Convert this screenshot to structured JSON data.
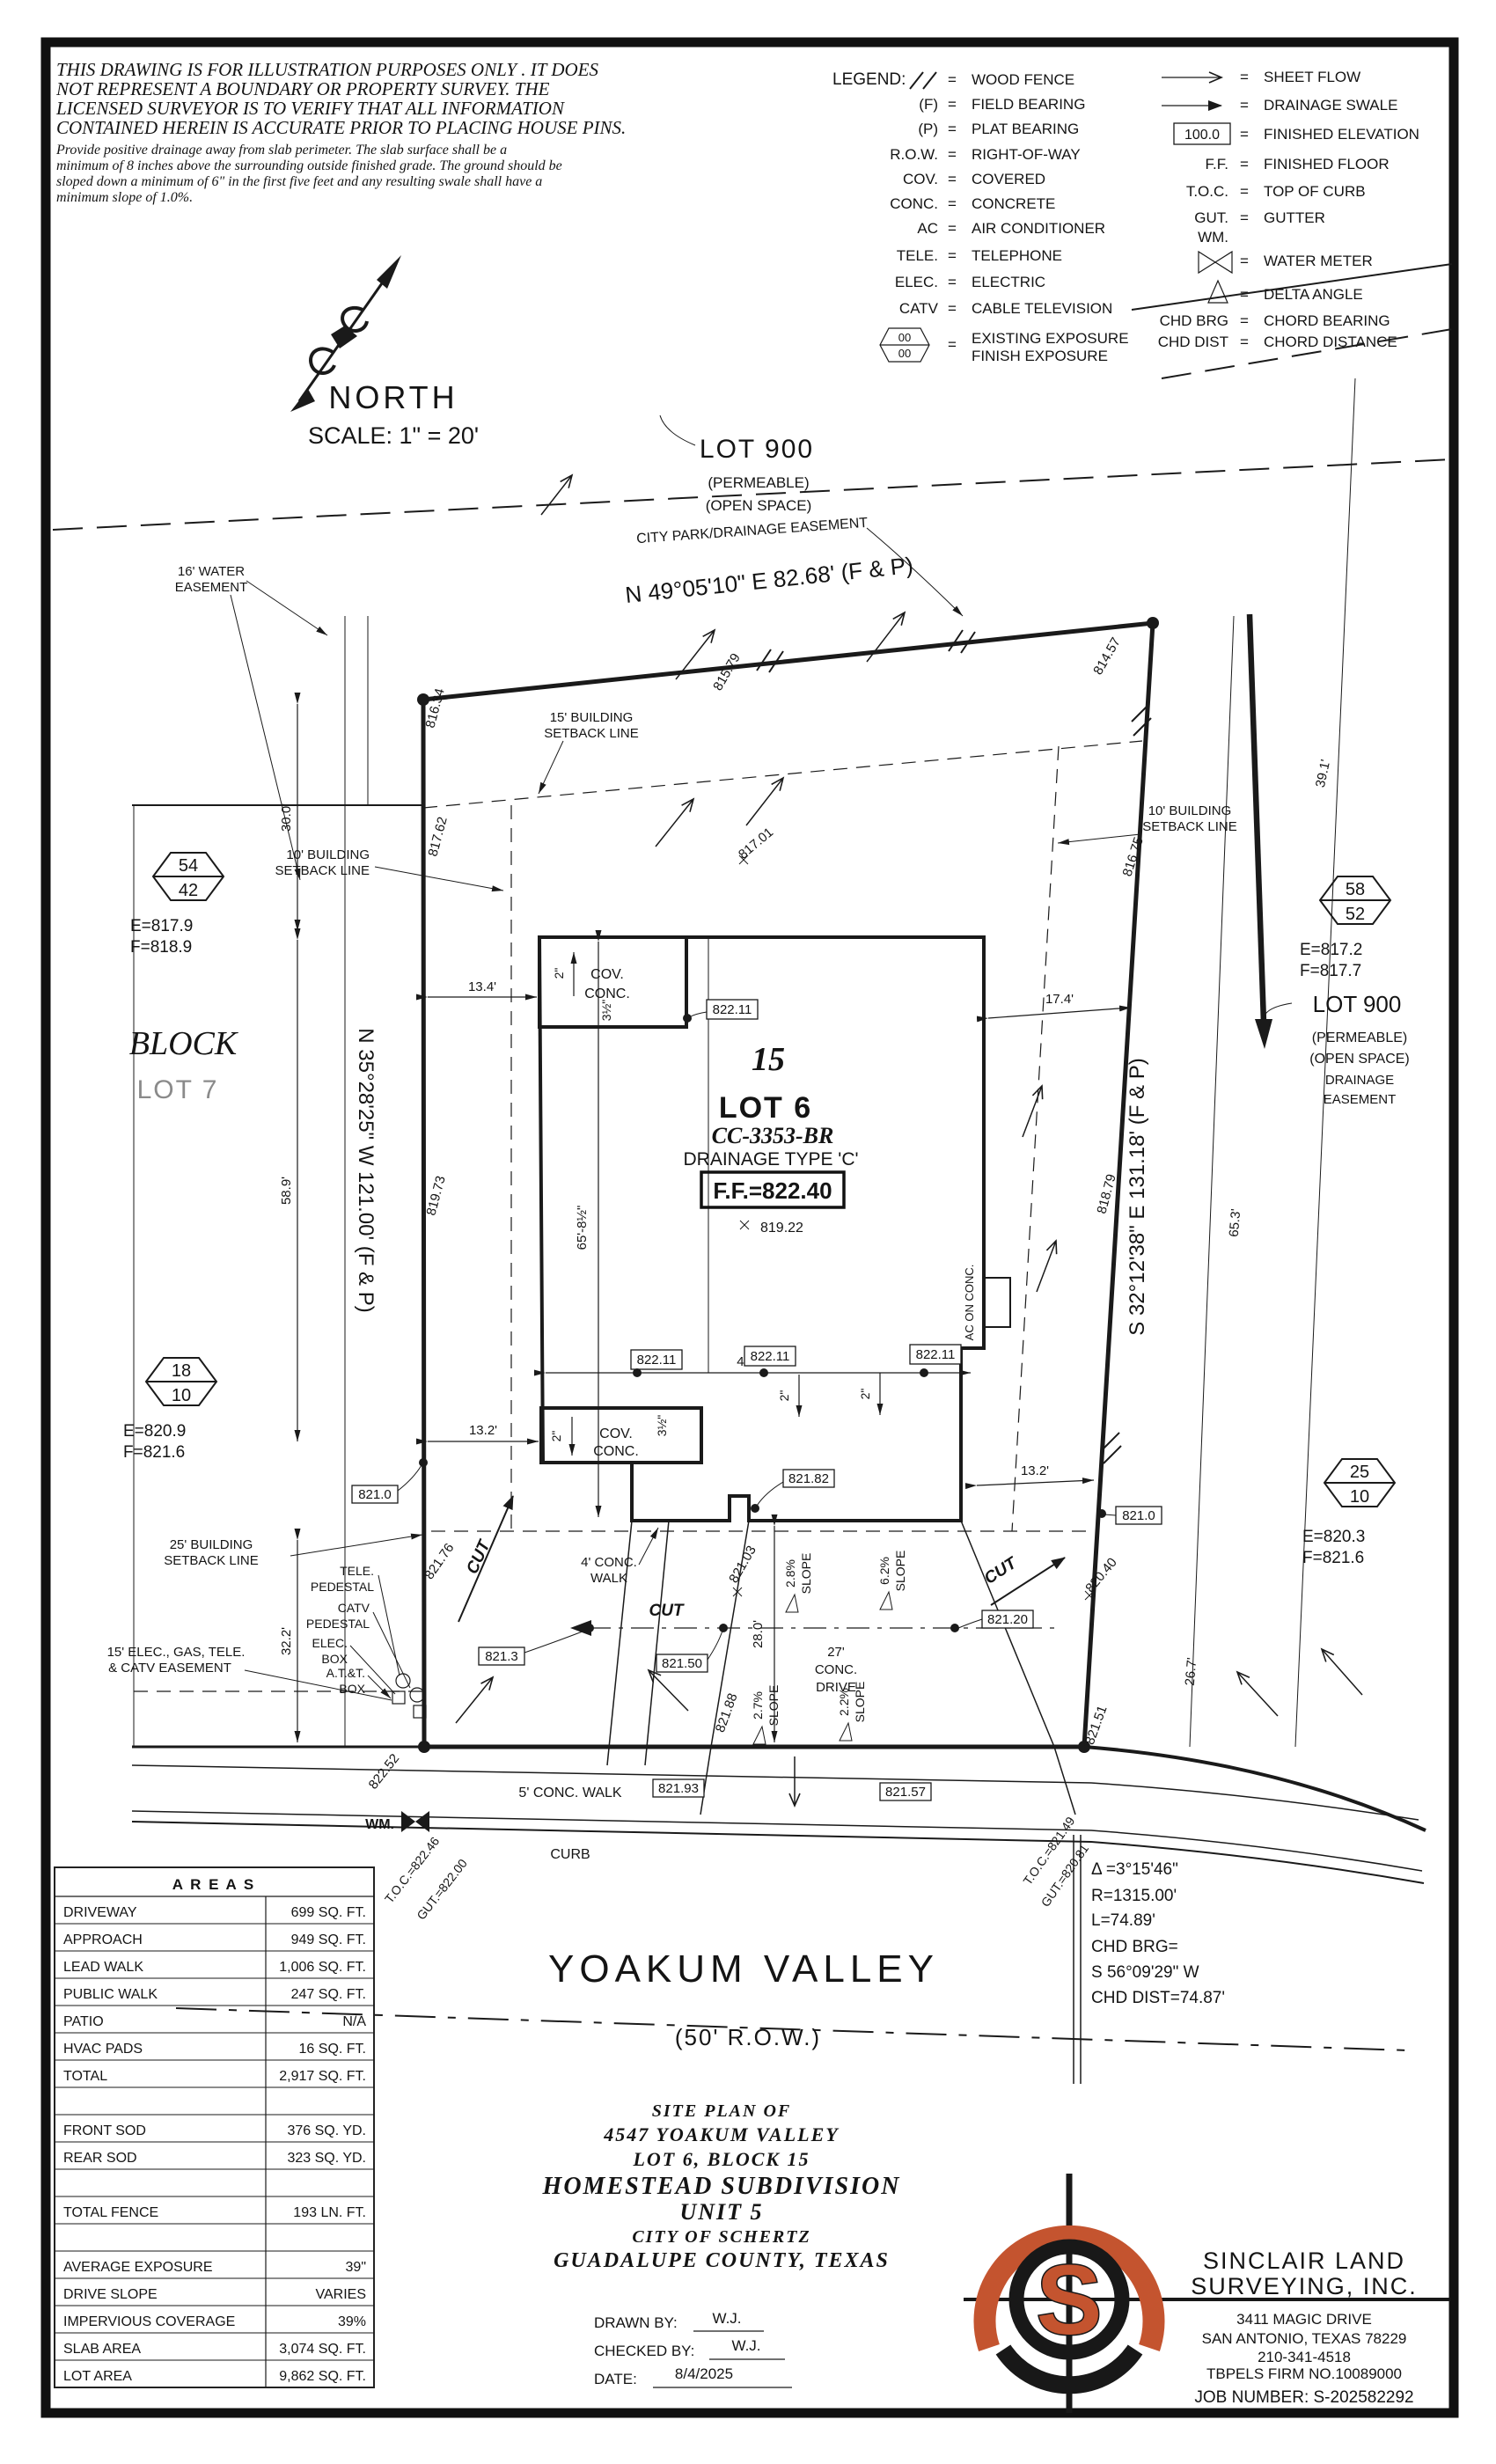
{
  "disclaimer": {
    "l1": "THIS DRAWING IS FOR ILLUSTRATION PURPOSES ONLY . IT DOES",
    "l2": "NOT REPRESENT A BOUNDARY OR PROPERTY SURVEY. THE",
    "l3": "LICENSED SURVEYOR IS TO VERIFY THAT ALL INFORMATION",
    "l4": "CONTAINED HEREIN IS ACCURATE PRIOR TO PLACING HOUSE PINS.",
    "s1": "Provide positive drainage away from slab perimeter. The slab surface shall be a",
    "s2": "minimum of 8 inches above the surrounding outside finished grade. The ground should be",
    "s3": "sloped down a minimum of 6\" in the first five feet and any resulting swale shall have a",
    "s4": "minimum slope of 1.0%."
  },
  "legend": {
    "title": "LEGEND:",
    "eq": "=",
    "hex_top": "00",
    "hex_bot": "00",
    "left": [
      {
        "sym": "",
        "def": "WOOD FENCE"
      },
      {
        "sym": "(F)",
        "def": "FIELD BEARING"
      },
      {
        "sym": "(P)",
        "def": "PLAT BEARING"
      },
      {
        "sym": "R.O.W.",
        "def": "RIGHT-OF-WAY"
      },
      {
        "sym": "COV.",
        "def": "COVERED"
      },
      {
        "sym": "CONC.",
        "def": "CONCRETE"
      },
      {
        "sym": "AC",
        "def": "AIR CONDITIONER"
      },
      {
        "sym": "TELE.",
        "def": "TELEPHONE"
      },
      {
        "sym": "ELEC.",
        "def": "ELECTRIC"
      },
      {
        "sym": "CATV",
        "def": "CABLE TELEVISION"
      },
      {
        "sym": "",
        "def": "EXISTING EXPOSURE"
      },
      {
        "sym": "",
        "def": "FINISH EXPOSURE"
      }
    ],
    "right": [
      {
        "sym": "",
        "def": "SHEET FLOW"
      },
      {
        "sym": "",
        "def": "DRAINAGE SWALE"
      },
      {
        "sym": "100.0",
        "def": "FINISHED ELEVATION"
      },
      {
        "sym": "F.F.",
        "def": "FINISHED FLOOR"
      },
      {
        "sym": "T.O.C.",
        "def": "TOP OF CURB"
      },
      {
        "sym": "GUT.",
        "def": "GUTTER"
      },
      {
        "sym": "WM.",
        "def": "WATER METER"
      },
      {
        "sym": "",
        "def": "DELTA ANGLE"
      },
      {
        "sym": "CHD BRG",
        "def": "CHORD BEARING"
      },
      {
        "sym": "CHD DIST",
        "def": "CHORD DISTANCE"
      }
    ]
  },
  "north": {
    "label": "NORTH",
    "scale": "SCALE: 1\" = 20'"
  },
  "bearings": {
    "top": "N 49°05'10\" E 82.68' (F & P)",
    "left": "N 35°28'25\" W 121.00' (F & P)",
    "right": "S 32°12'38\" E 131.18' (F & P)"
  },
  "lot900_top": {
    "name": "LOT 900",
    "l1": "(PERMEABLE)",
    "l2": "(OPEN SPACE)",
    "l3": "CITY PARK/DRAINAGE EASEMENT"
  },
  "lot900_right": {
    "name": "LOT 900",
    "l1": "(PERMEABLE)",
    "l2": "(OPEN SPACE)",
    "l3": "DRAINAGE",
    "l4": "EASEMENT"
  },
  "block": {
    "name": "BLOCK",
    "lot": "LOT 7"
  },
  "hex": [
    {
      "top": "54",
      "bot": "42",
      "e": "E=817.9",
      "f": "F=818.9"
    },
    {
      "top": "18",
      "bot": "10",
      "e": "E=820.9",
      "f": "F=821.6"
    },
    {
      "top": "58",
      "bot": "52",
      "e": "E=817.2",
      "f": "F=817.7"
    },
    {
      "top": "25",
      "bot": "10",
      "e": "E=820.3",
      "f": "F=821.6"
    }
  ],
  "house": {
    "block_num": "15",
    "lot": "LOT 6",
    "plan_code": "CC-3353-BR",
    "drainage": "DRAINAGE TYPE 'C'",
    "ff": "F.F.=822.40",
    "spot": "819.22",
    "cov1a": "COV.",
    "cov1b": "CONC.",
    "cov2a": "COV.",
    "cov2b": "CONC.",
    "ac": "AC ON CONC."
  },
  "setbacks": {
    "s15a": "15' BUILDING",
    "s15b": "SETBACK LINE",
    "s10la": "10' BUILDING",
    "s10lb": "SETBACK LINE",
    "s10ra": "10' BUILDING",
    "s10rb": "SETBACK LINE",
    "s25a": "25' BUILDING",
    "s25b": "SETBACK LINE"
  },
  "easements": {
    "w1": "16' WATER",
    "w2": "EASEMENT",
    "e1": "15' ELEC., GAS, TELE.",
    "e2": "& CATV EASEMENT"
  },
  "utilities": {
    "t1": "TELE.",
    "t2": "PEDESTAL",
    "c1": "CATV",
    "c2": "PEDESTAL",
    "el1": "ELEC.",
    "el2": "BOX",
    "a1": "A.T.&T.",
    "a2": "BOX"
  },
  "elev": {
    "e81634": "816.34",
    "e81579": "815.79",
    "e81457": "814.57",
    "e81762": "817.62",
    "e81701": "817.01",
    "e81675": "816.75",
    "e81973": "819.73",
    "e81879": "818.79",
    "e82176": "821.76",
    "e82040": "820.40",
    "e82103": "821.03",
    "e82188": "821.88",
    "e82151": "821.51",
    "e82252": "822.52"
  },
  "boxes": {
    "b1": "822.11",
    "b2": "822.11",
    "b3": "822.11",
    "b4": "822.11",
    "b5": "821.0",
    "b6": "821.0",
    "b7": "821.82",
    "b8": "821.3",
    "b9": "821.50",
    "b10": "821.20",
    "b11": "821.93",
    "b12": "821.57"
  },
  "dims": {
    "d134": "13.4'",
    "d174": "17.4'",
    "d300": "30.0'",
    "d589": "58.9'",
    "d322": "32.2'",
    "d658": "65'-8½\"",
    "d4911": "49'-11\"",
    "d132a": "13.2'",
    "d132b": "13.2'",
    "d280": "28.0'",
    "d391": "39.1'",
    "d653": "65.3'",
    "d267": "26.7'",
    "i2a": "2\"",
    "i2b": "2\"",
    "i2c": "2\"",
    "i2d": "2\"",
    "i35a": "3½\"",
    "i35b": "3½\""
  },
  "slopes": {
    "s1a": "2.8%",
    "s1b": "SLOPE",
    "s2a": "6.2%",
    "s2b": "SLOPE",
    "s3a": "2.7%",
    "s3b": "SLOPE",
    "s4a": "2.2%",
    "s4b": "SLOPE"
  },
  "flatwork": {
    "walk4a": "4' CONC.",
    "walk4b": "WALK",
    "drv1": "27'",
    "drv2": "CONC.",
    "drv3": "DRIVE",
    "walk5": "5' CONC. WALK",
    "curb": "CURB",
    "wm": "WM.",
    "cut1": "CUT",
    "cut2": "CUT",
    "cut3": "CUT"
  },
  "street": {
    "name": "YOAKUM VALLEY",
    "row": "(50' R.O.W.)"
  },
  "toc": {
    "t1": "T.O.C.=822.46",
    "g1": "GUT.=822.00",
    "t2": "T.O.C.=821.49",
    "g2": "GUT.=820.81"
  },
  "curve": {
    "l1": "Δ =3°15'46\"",
    "l2": "R=1315.00'",
    "l3": "L=74.89'",
    "l4": "CHD BRG=",
    "l5": "S 56°09'29\" W",
    "l6": "CHD DIST=74.87'"
  },
  "areas": {
    "title": "A R E A S",
    "rows": [
      {
        "label": "DRIVEWAY",
        "value": "699 SQ. FT."
      },
      {
        "label": "APPROACH",
        "value": "949 SQ. FT."
      },
      {
        "label": "LEAD WALK",
        "value": "1,006 SQ. FT."
      },
      {
        "label": "PUBLIC WALK",
        "value": "247 SQ. FT."
      },
      {
        "label": "PATIO",
        "value": "N/A"
      },
      {
        "label": "HVAC PADS",
        "value": "16 SQ. FT."
      },
      {
        "label": "TOTAL",
        "value": "2,917 SQ. FT."
      },
      {
        "label": "",
        "value": ""
      },
      {
        "label": "FRONT SOD",
        "value": "376 SQ. YD."
      },
      {
        "label": "REAR SOD",
        "value": "323 SQ. YD."
      },
      {
        "label": "",
        "value": ""
      },
      {
        "label": "TOTAL FENCE",
        "value": "193 LN. FT."
      },
      {
        "label": "",
        "value": ""
      },
      {
        "label": "AVERAGE EXPOSURE",
        "value": "39\""
      },
      {
        "label": "DRIVE SLOPE",
        "value": "VARIES"
      },
      {
        "label": "IMPERVIOUS COVERAGE",
        "value": "39%"
      },
      {
        "label": "SLAB AREA",
        "value": "3,074 SQ. FT."
      },
      {
        "label": "LOT AREA",
        "value": "9,862 SQ. FT."
      }
    ]
  },
  "title_block": {
    "l1": "SITE PLAN OF",
    "l2": "4547 YOAKUM VALLEY",
    "l3": "LOT 6, BLOCK 15",
    "l4": "HOMESTEAD SUBDIVISION",
    "l5": "UNIT 5",
    "l6": "CITY OF SCHERTZ",
    "l7": "GUADALUPE COUNTY, TEXAS",
    "drawn_label": "DRAWN BY:",
    "drawn": "W.J.",
    "checked_label": "CHECKED BY:",
    "checked": "W.J.",
    "date_label": "DATE:",
    "date": "8/4/2025"
  },
  "surveyor": {
    "n1": "SINCLAIR LAND",
    "n2": "SURVEYING, INC.",
    "a1": "3411 MAGIC DRIVE",
    "a2": "SAN ANTONIO, TEXAS 78229",
    "a3": "210-341-4518",
    "a4": "TBPELS FIRM NO.10089000",
    "job": "JOB NUMBER: S-202582292",
    "logo_s": "S"
  },
  "colors": {
    "accent": "#c4542f",
    "ink": "#1a1a1a"
  }
}
